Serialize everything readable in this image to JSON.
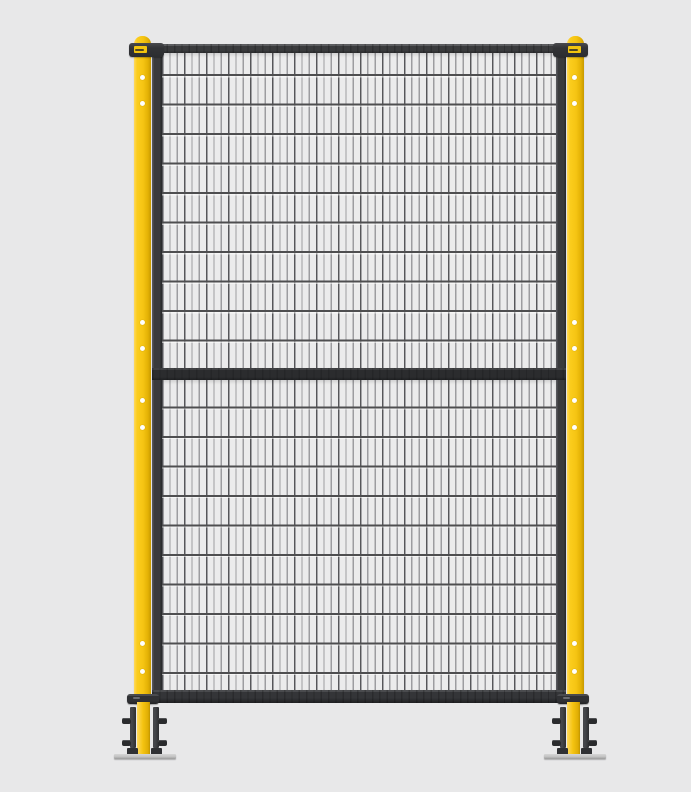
{
  "meta": {
    "description": "Product render of an industrial machine-guarding safety fence: one two-section wire-mesh panel mounted between two yellow floor-anchored posts",
    "visible_text": "none (only a tiny illegible yellow brand sticker on each top bracket)"
  },
  "colors": {
    "background": "#e8e8e9",
    "post_yellow": "#f5c412",
    "post_yellow_highlight": "#ffd95e",
    "post_yellow_shadow": "#c79a00",
    "frame_charcoal": "#3a3b3d",
    "mesh_background": "#ebebec",
    "mesh_wire_vertical": "#9c9ca0",
    "mesh_wire_horizontal": "#4e4e50",
    "bolt_dark": "#2a2b2d",
    "baseplate_silver": "#c2c2c2",
    "hole_white": "#ffffff",
    "label_yellow": "#f2c40e"
  },
  "structure": {
    "posts": [
      {
        "id": "left",
        "hole_center_x": 142,
        "holes_y": [
          77,
          103,
          322,
          348,
          400,
          427,
          643,
          671
        ]
      },
      {
        "id": "right",
        "hole_center_x": 574,
        "holes_y": [
          77,
          103,
          322,
          348,
          400,
          427,
          643,
          671
        ]
      }
    ],
    "panel": {
      "mesh_sections": 2,
      "vertical_wire_pitch_px": 7.33,
      "horizontal_wire_pitch_px": 29.5
    },
    "top_brackets": 2,
    "feet": 2
  }
}
